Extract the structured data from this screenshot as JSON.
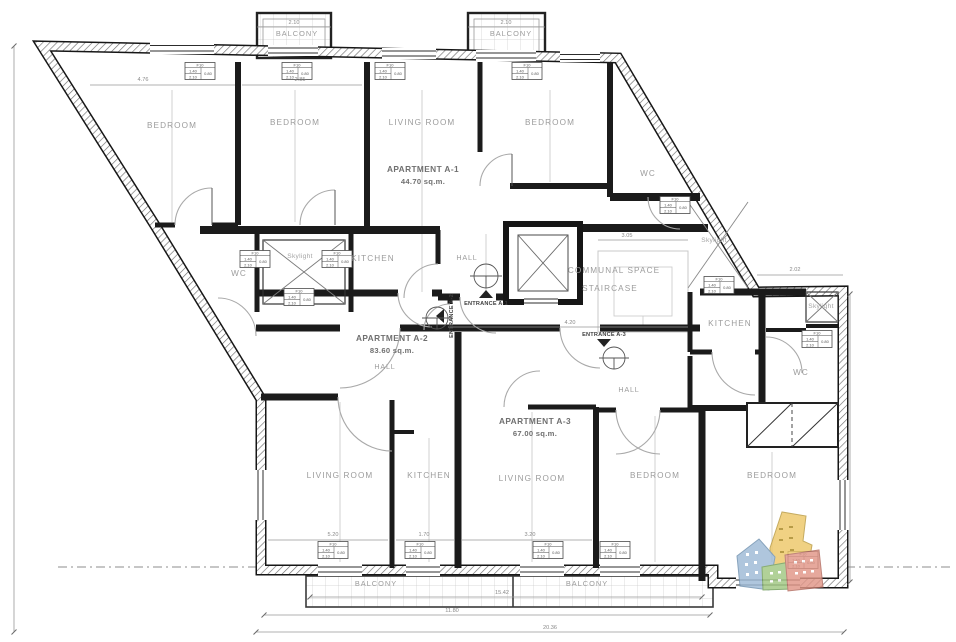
{
  "drawing": {
    "kind": "architectural floor plan",
    "colors": {
      "ink": "#1b1b1b",
      "hatch": "#6f6f6f",
      "room_label": "#9c9c9c",
      "dim_text": "#8a8a8a",
      "logo_blue": "#9ebad6",
      "logo_yellow": "#edc869",
      "logo_green": "#a0c882",
      "logo_red": "#e19687"
    }
  },
  "labels": {
    "rooms": [
      {
        "text": "BEDROOM",
        "x": 172,
        "y": 128,
        "k": "room"
      },
      {
        "text": "BEDROOM",
        "x": 295,
        "y": 125,
        "k": "room"
      },
      {
        "text": "LIVING ROOM",
        "x": 422,
        "y": 125,
        "k": "room"
      },
      {
        "text": "BEDROOM",
        "x": 550,
        "y": 125,
        "k": "room"
      },
      {
        "text": "WC",
        "x": 648,
        "y": 176,
        "k": "room"
      },
      {
        "text": "Skylight",
        "x": 714,
        "y": 242,
        "k": "sky"
      },
      {
        "text": "WC",
        "x": 239,
        "y": 276,
        "k": "room"
      },
      {
        "text": "Skylight",
        "x": 300,
        "y": 258,
        "k": "sky"
      },
      {
        "text": "KITCHEN",
        "x": 373,
        "y": 261,
        "k": "room"
      },
      {
        "text": "HALL",
        "x": 467,
        "y": 260,
        "k": "hall"
      },
      {
        "text": "COMMUNAL SPACE",
        "x": 614,
        "y": 273,
        "k": "room"
      },
      {
        "text": "STAIRCASE",
        "x": 610,
        "y": 291,
        "k": "room"
      },
      {
        "text": "KITCHEN",
        "x": 730,
        "y": 326,
        "k": "room"
      },
      {
        "text": "Skylight",
        "x": 821,
        "y": 308,
        "k": "sky"
      },
      {
        "text": "WC",
        "x": 801,
        "y": 375,
        "k": "room"
      },
      {
        "text": "HALL",
        "x": 629,
        "y": 392,
        "k": "hall"
      },
      {
        "text": "HALL",
        "x": 385,
        "y": 369,
        "k": "hall"
      },
      {
        "text": "LIVING ROOM",
        "x": 340,
        "y": 478,
        "k": "room"
      },
      {
        "text": "KITCHEN",
        "x": 429,
        "y": 478,
        "k": "room"
      },
      {
        "text": "LIVING ROOM",
        "x": 532,
        "y": 481,
        "k": "room"
      },
      {
        "text": "BEDROOM",
        "x": 655,
        "y": 478,
        "k": "room"
      },
      {
        "text": "BEDROOM",
        "x": 772,
        "y": 478,
        "k": "room"
      },
      {
        "text": "BALCONY",
        "x": 297,
        "y": 36,
        "k": "balc"
      },
      {
        "text": "BALCONY",
        "x": 511,
        "y": 36,
        "k": "balc"
      },
      {
        "text": "BALCONY",
        "x": 376,
        "y": 586,
        "k": "balc"
      },
      {
        "text": "BALCONY",
        "x": 587,
        "y": 586,
        "k": "balc"
      }
    ],
    "apartments": [
      {
        "name": "APARTMENT A-1",
        "area": "44.70 sq.m.",
        "x": 423,
        "y": 172
      },
      {
        "name": "APARTMENT A-2",
        "area": "83.60 sq.m.",
        "x": 392,
        "y": 341
      },
      {
        "name": "APARTMENT A-3",
        "area": "67.00 sq.m.",
        "x": 535,
        "y": 424
      }
    ],
    "entrances": [
      {
        "text": "ENTRANCE A-1",
        "x": 486,
        "y": 305,
        "r": 0
      },
      {
        "text": "ENTRANCE A-2",
        "x": 453,
        "y": 316,
        "r": -90
      },
      {
        "text": "ENTRANCE A-3",
        "x": 604,
        "y": 336,
        "r": 0
      }
    ],
    "dimensions": [
      {
        "t": "2.10",
        "x": 294,
        "y": 24
      },
      {
        "t": "2.10",
        "x": 506,
        "y": 24
      },
      {
        "t": "4.76",
        "x": 143,
        "y": 81
      },
      {
        "t": "2.85",
        "x": 300,
        "y": 81
      },
      {
        "t": "3.05",
        "x": 627,
        "y": 237
      },
      {
        "t": "4.20",
        "x": 570,
        "y": 324
      },
      {
        "t": "2.02",
        "x": 795,
        "y": 271
      },
      {
        "t": "5.20",
        "x": 333,
        "y": 536
      },
      {
        "t": "1.70",
        "x": 424,
        "y": 536
      },
      {
        "t": "3.20",
        "x": 530,
        "y": 536
      },
      {
        "t": "15.42",
        "x": 502,
        "y": 594
      },
      {
        "t": "11.80",
        "x": 452,
        "y": 612
      },
      {
        "t": "20.36",
        "x": 550,
        "y": 629
      }
    ]
  },
  "window_tag": {
    "header": "F10",
    "cell_left_top": "1.40",
    "cell_left_bottom": "2.10",
    "cell_right": "0.80"
  },
  "window_tag_positions": [
    [
      200,
      71
    ],
    [
      297,
      71
    ],
    [
      390,
      71
    ],
    [
      527,
      71
    ],
    [
      255,
      259
    ],
    [
      337,
      259
    ],
    [
      299,
      297
    ],
    [
      675,
      205
    ],
    [
      719,
      285
    ],
    [
      817,
      339
    ],
    [
      333,
      550
    ],
    [
      420,
      550
    ],
    [
      548,
      550
    ],
    [
      615,
      550
    ],
    [
      803,
      560
    ]
  ]
}
